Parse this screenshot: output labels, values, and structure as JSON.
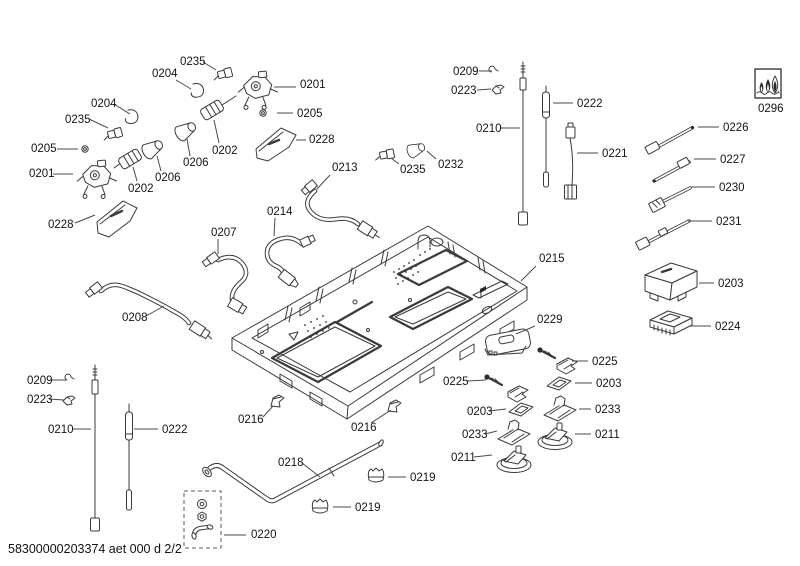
{
  "page": {
    "footer": "58300000203374 aet 000 d 2/2",
    "background": "#ffffff"
  },
  "diagram": {
    "type": "exploded-parts-diagram",
    "stroke_color": "#3a3a3a",
    "label_color": "#141414",
    "flame_icon": {
      "name": "gas-flames-icon",
      "label": "0296"
    },
    "labels": [
      {
        "text": "0235",
        "x": 180,
        "y": 65,
        "leader": [
          203,
          62,
          216,
          70
        ]
      },
      {
        "text": "0204",
        "x": 152,
        "y": 77,
        "leader": [
          176,
          80,
          191,
          89
        ]
      },
      {
        "text": "0201",
        "x": 300,
        "y": 88,
        "leader": [
          274,
          87,
          296,
          87
        ]
      },
      {
        "text": "0204",
        "x": 91,
        "y": 107,
        "leader": [
          114,
          104,
          130,
          114
        ]
      },
      {
        "text": "0235",
        "x": 65,
        "y": 123,
        "leader": [
          89,
          119,
          108,
          128
        ]
      },
      {
        "text": "0205",
        "x": 297,
        "y": 117,
        "leader": [
          277,
          113,
          293,
          113
        ]
      },
      {
        "text": "0205",
        "x": 31,
        "y": 152,
        "leader": [
          57,
          149,
          78,
          149
        ]
      },
      {
        "text": "0202",
        "x": 212,
        "y": 154,
        "leader": [
          219,
          143,
          214,
          120
        ]
      },
      {
        "text": "0228",
        "x": 309,
        "y": 143,
        "leader": [
          296,
          140,
          306,
          140
        ]
      },
      {
        "text": "0213",
        "x": 332,
        "y": 171,
        "leader": [
          330,
          175,
          317,
          189
        ]
      },
      {
        "text": "0206",
        "x": 183,
        "y": 166,
        "leader": [
          190,
          156,
          187,
          139
        ]
      },
      {
        "text": "0206",
        "x": 155,
        "y": 181,
        "leader": [
          161,
          171,
          157,
          156
        ]
      },
      {
        "text": "0202",
        "x": 128,
        "y": 192,
        "leader": [
          137,
          181,
          133,
          167
        ]
      },
      {
        "text": "0201",
        "x": 29,
        "y": 177,
        "leader": [
          53,
          174,
          73,
          174
        ]
      },
      {
        "text": "0228",
        "x": 48,
        "y": 228,
        "leader": [
          75,
          223,
          95,
          215
        ]
      },
      {
        "text": "0214",
        "x": 267,
        "y": 215,
        "leader": [
          275,
          218,
          274,
          236
        ]
      },
      {
        "text": "0207",
        "x": 211,
        "y": 236,
        "leader": [
          218,
          239,
          218,
          254
        ]
      },
      {
        "text": "0232",
        "x": 438,
        "y": 168,
        "leader": [
          436,
          159,
          427,
          151
        ]
      },
      {
        "text": "0235",
        "x": 400,
        "y": 173,
        "leader": [
          399,
          164,
          391,
          158
        ]
      },
      {
        "text": "0208",
        "x": 122,
        "y": 321,
        "leader": [
          146,
          316,
          164,
          306
        ]
      },
      {
        "text": "0215",
        "x": 539,
        "y": 262,
        "leader": [
          536,
          266,
          521,
          281
        ]
      },
      {
        "text": "0209",
        "x": 453,
        "y": 75,
        "leader": [
          479,
          71,
          492,
          71
        ]
      },
      {
        "text": "0223",
        "x": 451,
        "y": 94,
        "leader": [
          477,
          90,
          491,
          89
        ]
      },
      {
        "text": "0222",
        "x": 577,
        "y": 107,
        "leader": [
          553,
          103,
          573,
          103
        ]
      },
      {
        "text": "0210",
        "x": 476,
        "y": 132,
        "leader": [
          501,
          128,
          520,
          128
        ]
      },
      {
        "text": "0221",
        "x": 602,
        "y": 157,
        "leader": [
          577,
          153,
          598,
          153
        ]
      },
      {
        "text": "0296",
        "x": 758,
        "y": 112
      },
      {
        "text": "0226",
        "x": 723,
        "y": 131,
        "leader": [
          698,
          127,
          719,
          127
        ]
      },
      {
        "text": "0227",
        "x": 720,
        "y": 163,
        "leader": [
          694,
          159,
          716,
          159
        ]
      },
      {
        "text": "0230",
        "x": 719,
        "y": 191,
        "leader": [
          691,
          187,
          715,
          187
        ]
      },
      {
        "text": "0231",
        "x": 716,
        "y": 225,
        "leader": [
          688,
          221,
          712,
          221
        ]
      },
      {
        "text": "0203",
        "x": 718,
        "y": 287,
        "leader": [
          699,
          283,
          714,
          283
        ]
      },
      {
        "text": "0224",
        "x": 715,
        "y": 330,
        "leader": [
          690,
          326,
          711,
          326
        ]
      },
      {
        "text": "0229",
        "x": 537,
        "y": 323,
        "leader": [
          535,
          326,
          516,
          334
        ]
      },
      {
        "text": "0225",
        "x": 592,
        "y": 365,
        "leader": [
          572,
          361,
          588,
          361
        ]
      },
      {
        "text": "0203",
        "x": 596,
        "y": 387,
        "leader": [
          575,
          383,
          592,
          383
        ]
      },
      {
        "text": "0233",
        "x": 595,
        "y": 413,
        "leader": [
          579,
          409,
          591,
          409
        ]
      },
      {
        "text": "0211",
        "x": 595,
        "y": 438,
        "leader": [
          575,
          434,
          591,
          434
        ]
      },
      {
        "text": "0225",
        "x": 443,
        "y": 385,
        "leader": [
          467,
          381,
          486,
          380
        ]
      },
      {
        "text": "0203",
        "x": 467,
        "y": 415,
        "leader": [
          489,
          411,
          506,
          409
        ]
      },
      {
        "text": "0233",
        "x": 462,
        "y": 438,
        "leader": [
          485,
          434,
          497,
          431
        ]
      },
      {
        "text": "0211",
        "x": 451,
        "y": 461,
        "leader": [
          474,
          457,
          492,
          455
        ]
      },
      {
        "text": "0216",
        "x": 238,
        "y": 423,
        "leader": [
          263,
          417,
          273,
          406
        ]
      },
      {
        "text": "0216",
        "x": 351,
        "y": 431,
        "leader": [
          371,
          423,
          391,
          410
        ]
      },
      {
        "text": "0218",
        "x": 278,
        "y": 466,
        "leader": [
          302,
          463,
          320,
          477
        ]
      },
      {
        "text": "0219",
        "x": 410,
        "y": 481,
        "leader": [
          388,
          477,
          406,
          477
        ]
      },
      {
        "text": "0219",
        "x": 355,
        "y": 511,
        "leader": [
          333,
          507,
          351,
          507
        ]
      },
      {
        "text": "0220",
        "x": 251,
        "y": 538,
        "leader": [
          224,
          535,
          246,
          535
        ]
      },
      {
        "text": "0209",
        "x": 27,
        "y": 384,
        "leader": [
          50,
          380,
          66,
          380
        ]
      },
      {
        "text": "0223",
        "x": 27,
        "y": 403,
        "leader": [
          49,
          399,
          64,
          400
        ]
      },
      {
        "text": "0210",
        "x": 48,
        "y": 433,
        "leader": [
          73,
          429,
          91,
          429
        ]
      },
      {
        "text": "0222",
        "x": 162,
        "y": 433,
        "leader": [
          134,
          429,
          158,
          429
        ]
      }
    ]
  }
}
